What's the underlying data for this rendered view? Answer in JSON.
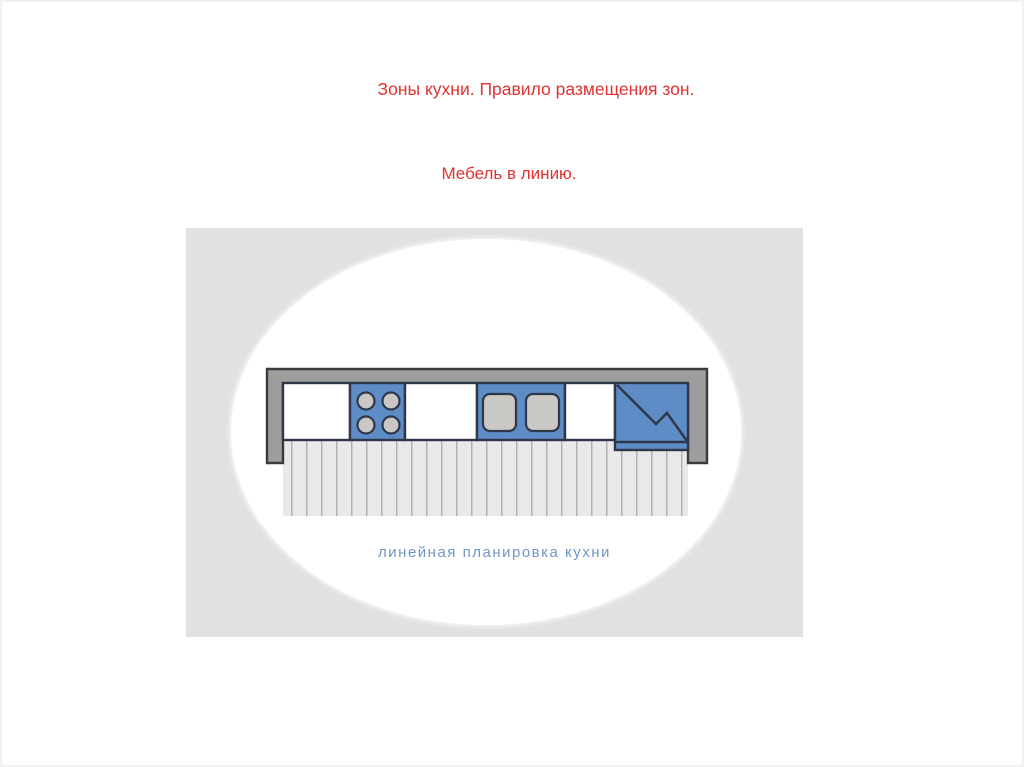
{
  "slide": {
    "title": "Зоны кухни. Правило размещения зон.",
    "subtitle": "Мебель в линию."
  },
  "figure": {
    "caption": "линейная планировка кухни",
    "icons": {
      "cooktop": "cooktop-burners-icon",
      "sink": "double-sink-icon",
      "refrigerator": "refrigerator-icon",
      "floor": "floor-hatch-pattern"
    }
  },
  "colors": {
    "title_red": "#e23232",
    "figure_bg": "#e1e1e1",
    "ellipse_white": "#ffffff",
    "wall_gray": "#9d9d9d",
    "outline_dark": "#3a3a3a",
    "unit_blue": "#5e8cc7",
    "unit_outline": "#2d3748",
    "fixture_gray": "#cac8c4",
    "hatch_bg": "#e9e9e9",
    "hatch_line": "#b2b2b2",
    "caption_blue": "#7096c5"
  }
}
